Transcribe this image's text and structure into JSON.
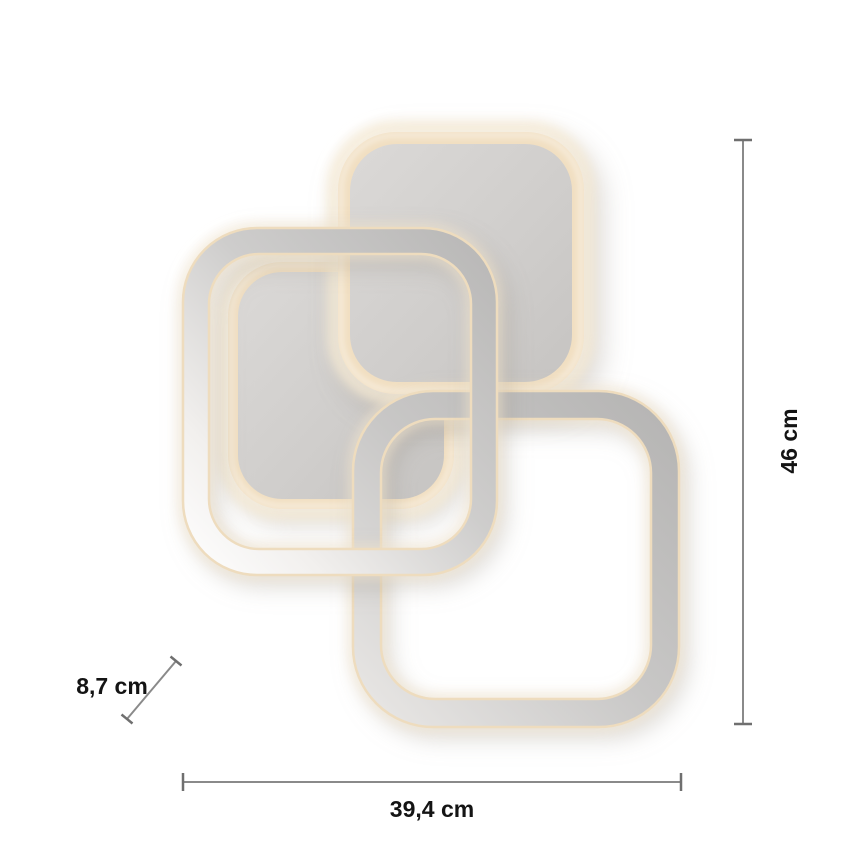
{
  "figure": {
    "kind": "product-dimension-diagram",
    "subject": "LED ceiling light of three overlapping rounded squares",
    "background_color": "#ffffff"
  },
  "dimensions": {
    "height_label": "46 cm",
    "width_label": "39,4 cm",
    "depth_label": "8,7 cm"
  },
  "lamp": {
    "part_names": [
      "top-square-panel",
      "inner-square-panel",
      "left-square-frame",
      "bottom-right-square-frame"
    ],
    "glow_color": "#f1dfc2",
    "glow_halo_color": "#f6ebd6",
    "metal_gray": "#c0bfbe",
    "panel_gray": "#d2d0ce"
  },
  "annotation": {
    "line_color": "#8a8a8a",
    "cap_color": "#6f6f6f",
    "text_color": "#141414"
  }
}
